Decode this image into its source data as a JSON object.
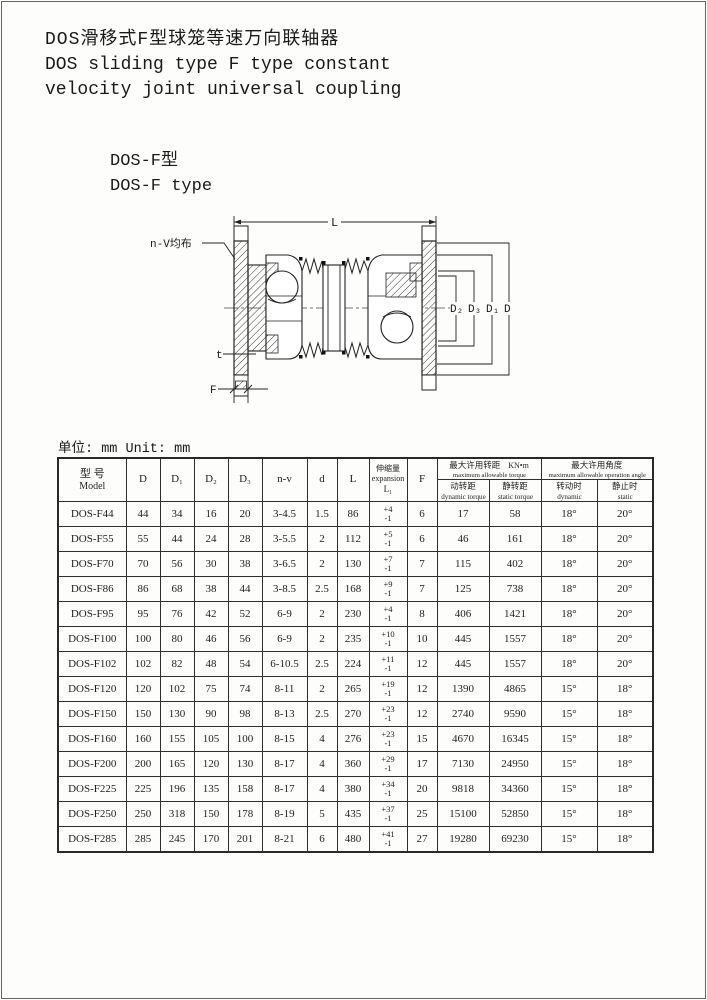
{
  "page": {
    "title_zh": "DOS滑移式F型球笼等速万向联轴器",
    "title_en_line1": "DOS sliding type F type constant",
    "title_en_line2": "velocity joint universal coupling",
    "subtitle_zh": "DOS-F型",
    "subtitle_en": "DOS-F type",
    "unit_note": "单位: mm Unit: mm"
  },
  "drawing": {
    "labels": {
      "L": "L",
      "n_v": "n-V均布",
      "t": "t",
      "F": "F",
      "D2": "D₂",
      "D3": "D₃",
      "D1": "D₁",
      "D": "D"
    }
  },
  "table": {
    "headers": {
      "model_zh": "型 号",
      "model_en": "Model",
      "D": "D",
      "D1": "D₁",
      "D2": "D₂",
      "D3": "D₃",
      "n_v": "n-v",
      "d": "d",
      "L": "L",
      "expansion_zh": "伸缩量",
      "expansion_en": "expansion",
      "expansion_sym": "L₁",
      "F": "F",
      "torque_zh": "最大许用转距",
      "torque_en": "maximum allowable torque",
      "torque_unit": "KN•m",
      "dyn_torque_zh": "动转距",
      "dyn_torque_en": "dynamic torque",
      "stat_torque_zh": "静转距",
      "stat_torque_en": "static torque",
      "angle_zh": "最大许用角度",
      "angle_en": "maximum allowable operation angle",
      "dyn_angle_zh": "转动时",
      "dyn_angle_en": "dynamic",
      "stat_angle_zh": "静止时",
      "stat_angle_en": "static"
    },
    "rows": [
      [
        "DOS-F44",
        "44",
        "34",
        "16",
        "20",
        "3-4.5",
        "1.5",
        "86",
        [
          "+4",
          "-1"
        ],
        "6",
        "17",
        "58",
        "18°",
        "20°"
      ],
      [
        "DOS-F55",
        "55",
        "44",
        "24",
        "28",
        "3-5.5",
        "2",
        "112",
        [
          "+5",
          "-1"
        ],
        "6",
        "46",
        "161",
        "18°",
        "20°"
      ],
      [
        "DOS-F70",
        "70",
        "56",
        "30",
        "38",
        "3-6.5",
        "2",
        "130",
        [
          "+7",
          "-1"
        ],
        "7",
        "115",
        "402",
        "18°",
        "20°"
      ],
      [
        "DOS-F86",
        "86",
        "68",
        "38",
        "44",
        "3-8.5",
        "2.5",
        "168",
        [
          "+9",
          "-1"
        ],
        "7",
        "125",
        "738",
        "18°",
        "20°"
      ],
      [
        "DOS-F95",
        "95",
        "76",
        "42",
        "52",
        "6-9",
        "2",
        "230",
        [
          "+4",
          "-1"
        ],
        "8",
        "406",
        "1421",
        "18°",
        "20°"
      ],
      [
        "DOS-F100",
        "100",
        "80",
        "46",
        "56",
        "6-9",
        "2",
        "235",
        [
          "+10",
          "-1"
        ],
        "10",
        "445",
        "1557",
        "18°",
        "20°"
      ],
      [
        "DOS-F102",
        "102",
        "82",
        "48",
        "54",
        "6-10.5",
        "2.5",
        "224",
        [
          "+11",
          "-1"
        ],
        "12",
        "445",
        "1557",
        "18°",
        "20°"
      ],
      [
        "DOS-F120",
        "120",
        "102",
        "75",
        "74",
        "8-11",
        "2",
        "265",
        [
          "+19",
          "-1"
        ],
        "12",
        "1390",
        "4865",
        "15°",
        "18°"
      ],
      [
        "DOS-F150",
        "150",
        "130",
        "90",
        "98",
        "8-13",
        "2.5",
        "270",
        [
          "+23",
          "-1"
        ],
        "12",
        "2740",
        "9590",
        "15°",
        "18°"
      ],
      [
        "DOS-F160",
        "160",
        "155",
        "105",
        "100",
        "8-15",
        "4",
        "276",
        [
          "+23",
          "-1"
        ],
        "15",
        "4670",
        "16345",
        "15°",
        "18°"
      ],
      [
        "DOS-F200",
        "200",
        "165",
        "120",
        "130",
        "8-17",
        "4",
        "360",
        [
          "+29",
          "-1"
        ],
        "17",
        "7130",
        "24950",
        "15°",
        "18°"
      ],
      [
        "DOS-F225",
        "225",
        "196",
        "135",
        "158",
        "8-17",
        "4",
        "380",
        [
          "+34",
          "-1"
        ],
        "20",
        "9818",
        "34360",
        "15°",
        "18°"
      ],
      [
        "DOS-F250",
        "250",
        "318",
        "150",
        "178",
        "8-19",
        "5",
        "435",
        [
          "+37",
          "-1"
        ],
        "25",
        "15100",
        "52850",
        "15°",
        "18°"
      ],
      [
        "DOS-F285",
        "285",
        "245",
        "170",
        "201",
        "8-21",
        "6",
        "480",
        [
          "+41",
          "-1"
        ],
        "27",
        "19280",
        "69230",
        "15°",
        "18°"
      ]
    ]
  }
}
